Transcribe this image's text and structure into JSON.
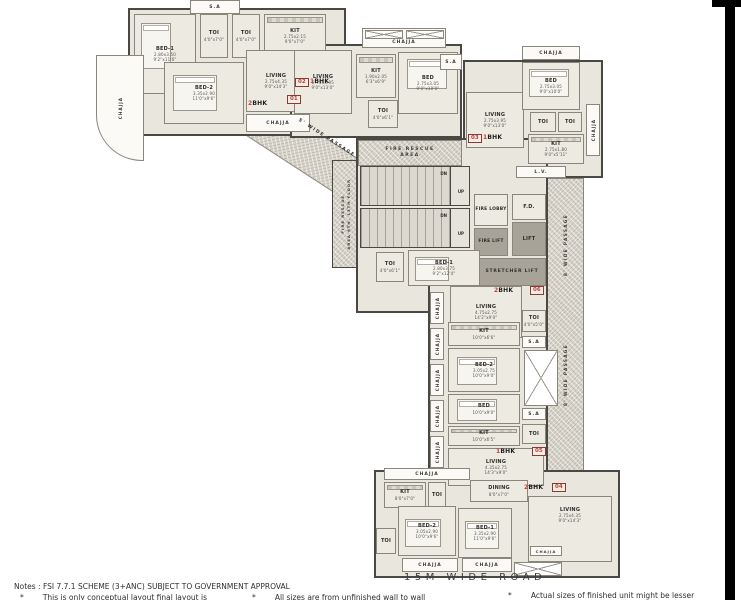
{
  "page": {
    "road": "15M WIDE ROAD",
    "notes_heading": "Notes : FSI 7.7.1 SCHEME (3+ANC) SUBJECT TO GOVERNMENT APPROVAL",
    "note1": "*        This is only conceptual layout final layout is",
    "note2": "*        All sizes are from unfinished wall to wall",
    "note3": "*        Actual sizes of finished unit might be lesser"
  },
  "colors": {
    "accent_red": "#b8443a",
    "wall_dark": "#4a4843",
    "room_fill": "#edeae2",
    "passage_fill": "#d8d4ca",
    "lift_fill": "#a8a399"
  },
  "labels": {
    "chajja": "CHAJJA",
    "sa": "S.A",
    "lv": "L.V.",
    "dn": "DN",
    "up": "UP",
    "fd": "F.D.",
    "fire_lobby": "FIRE LOBBY",
    "fire_lift": "FIRE LIFT",
    "lift": "LIFT",
    "stretcher_lift": "STRETCHER LIFT",
    "fire_rescue_1": "FIRE RESCUE",
    "fire_rescue_2": "AREA",
    "fire_rescue_floors_1": "FIRE RESCUE",
    "fire_rescue_floors_2": "AREA 6TH, 13TH FLOOR",
    "passage5": "5' WIDE PASSAGE",
    "passage8": "8' WIDE PASSAGE"
  },
  "units": {
    "u1": {
      "marker": "01",
      "bhk_num": "2",
      "bhk_txt": "BHK"
    },
    "u2": {
      "marker": "02",
      "bhk_num": "1",
      "bhk_txt": "BHK"
    },
    "u3": {
      "marker": "03",
      "bhk_num": "1",
      "bhk_txt": "BHK"
    },
    "u4": {
      "marker": "04",
      "bhk_num": "2",
      "bhk_txt": "BHK"
    },
    "u5": {
      "marker": "05",
      "bhk_num": "1",
      "bhk_txt": "BHK"
    },
    "u6": {
      "marker": "06",
      "bhk_num": "2",
      "bhk_txt": "BHK"
    }
  },
  "rooms": {
    "u1_bed1": {
      "n": "BED-1",
      "m": "2.80x3.50",
      "f": "9'2\"x11'6\""
    },
    "u1_bed2": {
      "n": "BED-2",
      "m": "3.35x2.90",
      "f": "11'0\"x9'6\""
    },
    "u1_living": {
      "n": "LIVING",
      "m": "2.75x4.35",
      "f": "9'0\"x14'3\""
    },
    "u1_kit": {
      "n": "KIT",
      "m": "2.75x2.15",
      "f": "9'0\"x7'0\""
    },
    "u1_toi1": {
      "n": "TOI",
      "m": "1.20x2.15",
      "f": "4'0\"x7'0\""
    },
    "u1_toi2": {
      "n": "TOI",
      "m": "1.20x2.15",
      "f": "4'0\"x7'0\""
    },
    "u2_living": {
      "n": "LIVING",
      "m": "2.75x3.95",
      "f": "9'0\"x13'0\""
    },
    "u2_kit": {
      "n": "KIT",
      "m": "1.90x2.05",
      "f": "6'3\"x6'9\""
    },
    "u2_bed": {
      "n": "BED",
      "m": "2.75x3.05",
      "f": "9'0\"x10'0\""
    },
    "u2_toi": {
      "n": "TOI",
      "m": "1.20x1.85",
      "f": "4'0\"x6'1\""
    },
    "u3_living": {
      "n": "LIVING",
      "m": "2.75x3.95",
      "f": "9'0\"x13'0\""
    },
    "u3_bed": {
      "n": "BED",
      "m": "2.75x3.05",
      "f": "9'0\"x10'0\""
    },
    "u3_kit": {
      "n": "KIT",
      "m": "2.75x1.80",
      "f": "9'0\"x5'11\""
    },
    "u3_toi1": {
      "n": "TOI",
      "m": "1.20x1.85",
      "f": "4'0\"x6'1\""
    },
    "u3_toi2": {
      "n": "TOI",
      "m": "1.20x1.85",
      "f": "4'0\"x6'1\""
    },
    "u6_bed1": {
      "n": "BED-1",
      "m": "2.80x3.75",
      "f": "9'2\"x12'4\""
    },
    "u6_toi1": {
      "n": "TOI",
      "m": "1.20x1.85",
      "f": "4'0\"x6'1\""
    },
    "u6_living": {
      "n": "LIVING",
      "m": "4.75x2.75",
      "f": "14'2\"x9'0\""
    },
    "u6_toi2": {
      "n": "TOI",
      "m": "1.20x1.50",
      "f": "4'0\"x5'0\""
    },
    "u6_kit": {
      "n": "KIT",
      "m": "3.00x2.00",
      "f": "10'0\"x6'6\""
    },
    "u6_bed2": {
      "n": "BED-2",
      "m": "3.05x2.75",
      "f": "10'0\"x9'0\""
    },
    "u5_bed": {
      "n": "BED",
      "m": "3.05x2.75",
      "f": "10'0\"x9'0\""
    },
    "u5_kit": {
      "n": "KIT",
      "m": "3.00x1.95",
      "f": "10'0\"x6'5\""
    },
    "u5_toi": {
      "n": "TOI",
      "m": "1.20x1.85",
      "f": "4'0\"x6'1\""
    },
    "u5_living": {
      "n": "LIVING",
      "m": "4.35x2.75",
      "f": "14'3\"x9'0\""
    },
    "u4_dining": {
      "n": "DINING",
      "m": "2.45x2.15",
      "f": "8'0\"x7'0\""
    },
    "u4_living": {
      "n": "LIVING",
      "m": "2.75x4.35",
      "f": "9'0\"x14'3\""
    },
    "u4_kit": {
      "n": "KIT",
      "m": "2.45x2.15",
      "f": "8'0\"x7'0\""
    },
    "u4_toi1": {
      "n": "TOI",
      "m": "1.20x1.85",
      "f": "4'0\"x6'1\""
    },
    "u4_toi2": {
      "n": "TOI",
      "m": "1.20x1.85",
      "f": "4'0\"x6'1\""
    },
    "u4_bed1": {
      "n": "BED-1",
      "m": "3.35x2.90",
      "f": "11'0\"x9'6\""
    },
    "u4_bed2": {
      "n": "BED-2",
      "m": "3.05x2.90",
      "f": "10'0\"x9'6\""
    }
  }
}
